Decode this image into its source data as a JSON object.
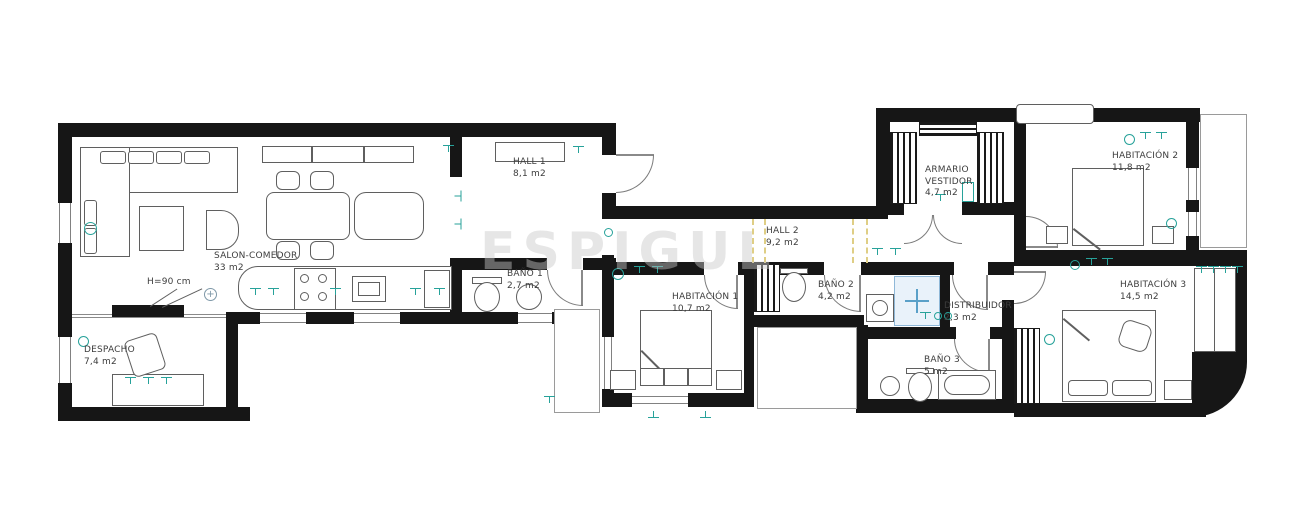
{
  "watermark": {
    "text": "ESPIGUL"
  },
  "rooms": {
    "salon": {
      "name": "SALON-COMEDOR",
      "area": "33 m2"
    },
    "despacho": {
      "name": "DESPACHO",
      "area": "7,4 m2"
    },
    "hall1": {
      "name": "HALL 1",
      "area": "8,1 m2"
    },
    "bano1": {
      "name": "BAÑO 1",
      "area": "2,7 m2"
    },
    "habitacion1": {
      "name": "HABITACIÓN 1",
      "area": "10,7 m2"
    },
    "hall2": {
      "name": "HALL 2",
      "area": "9,2 m2"
    },
    "bano2": {
      "name": "BAÑO 2",
      "area": "4,2 m2"
    },
    "distribuidor": {
      "name": "DISTRIBUIDOR",
      "area": "2,3 m2"
    },
    "bano3": {
      "name": "BAÑO 3",
      "area": "5 m2"
    },
    "armario": {
      "name": "ARMARIO VESTIDOR",
      "area": "4,7 m2"
    },
    "habitacion2": {
      "name": "HABITACIÓN 2",
      "area": "11,8 m2"
    },
    "habitacion3": {
      "name": "HABITACIÓN 3",
      "area": "14,5 m2"
    }
  },
  "annotations": {
    "counter_height": "H=90 cm"
  },
  "colors": {
    "wall": "#161616",
    "fixture_teal": "#27a29a",
    "shower_blue": "#8fb8d8",
    "beam_yellow": "#dfce85",
    "watermark_gray": "#c8c8c8"
  }
}
